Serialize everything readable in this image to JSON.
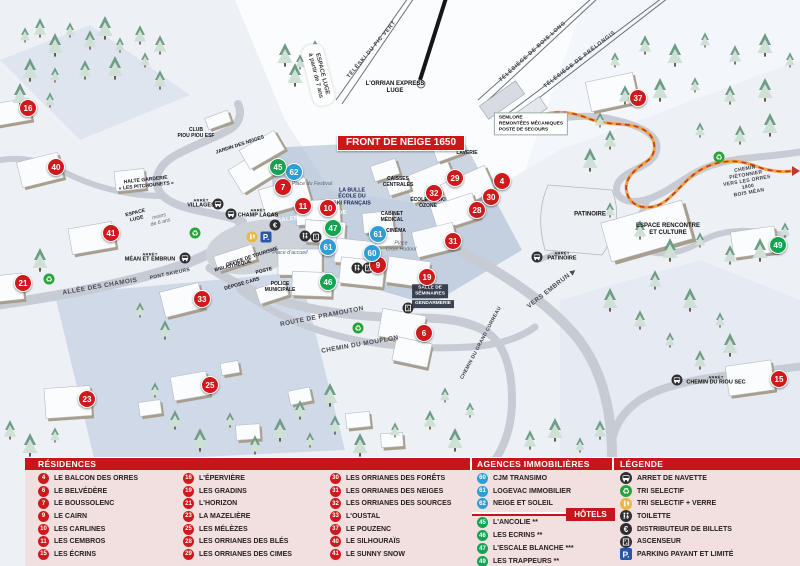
{
  "colors": {
    "residence": "#cf1a1d",
    "agence": "#2e9fd4",
    "hotel": "#13a453",
    "header": "#c6161c",
    "panel_bg": "#f2dfdf",
    "banner": "#cc1719",
    "path_orange": "#f0a23c"
  },
  "map": {
    "banner": "FRONT DE NEIGE 1650",
    "markers": [
      {
        "num": "16",
        "type": "res",
        "x": 28,
        "y": 108
      },
      {
        "num": "40",
        "type": "res",
        "x": 56,
        "y": 167
      },
      {
        "num": "41",
        "type": "res",
        "x": 111,
        "y": 233
      },
      {
        "num": "21",
        "type": "res",
        "x": 23,
        "y": 283
      },
      {
        "num": "33",
        "type": "res",
        "x": 202,
        "y": 299
      },
      {
        "num": "23",
        "type": "res",
        "x": 87,
        "y": 399
      },
      {
        "num": "25",
        "type": "res",
        "x": 210,
        "y": 385
      },
      {
        "num": "7",
        "type": "res",
        "x": 283,
        "y": 187
      },
      {
        "num": "11",
        "type": "res",
        "x": 303,
        "y": 206
      },
      {
        "num": "10",
        "type": "res",
        "x": 328,
        "y": 208
      },
      {
        "num": "9",
        "type": "res",
        "x": 378,
        "y": 265
      },
      {
        "num": "19",
        "type": "res",
        "x": 427,
        "y": 277
      },
      {
        "num": "6",
        "type": "res",
        "x": 424,
        "y": 333
      },
      {
        "num": "29",
        "type": "res",
        "x": 455,
        "y": 178
      },
      {
        "num": "32",
        "type": "res",
        "x": 434,
        "y": 193
      },
      {
        "num": "30",
        "type": "res",
        "x": 491,
        "y": 197
      },
      {
        "num": "4",
        "type": "res",
        "x": 502,
        "y": 181
      },
      {
        "num": "28",
        "type": "res",
        "x": 477,
        "y": 210
      },
      {
        "num": "31",
        "type": "res",
        "x": 453,
        "y": 241
      },
      {
        "num": "37",
        "type": "res",
        "x": 638,
        "y": 98
      },
      {
        "num": "15",
        "type": "res",
        "x": 779,
        "y": 379
      },
      {
        "num": "62",
        "type": "agence",
        "x": 294,
        "y": 172
      },
      {
        "num": "61",
        "type": "agence",
        "x": 328,
        "y": 247
      },
      {
        "num": "61",
        "type": "agence",
        "x": 378,
        "y": 234
      },
      {
        "num": "60",
        "type": "agence",
        "x": 372,
        "y": 253
      },
      {
        "num": "45",
        "type": "hotel",
        "x": 278,
        "y": 167
      },
      {
        "num": "47",
        "type": "hotel",
        "x": 333,
        "y": 228
      },
      {
        "num": "46",
        "type": "hotel",
        "x": 328,
        "y": 282
      },
      {
        "num": "49",
        "type": "hotel",
        "x": 778,
        "y": 245
      }
    ],
    "labels": [
      {
        "text": "ESPACE LUGE\nà partir de 7 ans",
        "x": 318,
        "y": 75,
        "rot": 76,
        "cls": "pill"
      },
      {
        "text": "TÉLÉSKI DU PIC VERT",
        "x": 372,
        "y": 50,
        "rot": -50,
        "cls": "lift"
      },
      {
        "text": "TÉLÉSIÈGE DE BOIS LONG",
        "x": 533,
        "y": 52,
        "rot": -42,
        "cls": "lift"
      },
      {
        "text": "TÉLÉSIÈGE DE PRÉLONGIS",
        "x": 580,
        "y": 60,
        "rot": -38,
        "cls": "lift"
      },
      {
        "text": "L'ORRIAN EXPRESS\nLUGE",
        "x": 395,
        "y": 88,
        "cls": "poi"
      },
      {
        "text": "SEMLORE\nREMONTÉES MÉCANIQUES\nPOSTE DE SECOURS",
        "x": 531,
        "y": 124,
        "cls": "box"
      },
      {
        "text": "CLUB\nPIOU PIOU ESF",
        "x": 196,
        "y": 133,
        "cls": "poi-sm"
      },
      {
        "text": "JARDIN DES NEIGES",
        "x": 240,
        "y": 145,
        "rot": -18,
        "cls": "poi-sm"
      },
      {
        "text": "HALTE GARDERIE\n« LES PITCHOUNETS »",
        "x": 146,
        "y": 183,
        "rot": -6,
        "cls": "poi-sm"
      },
      {
        "text": "ESPACE\nLUGE",
        "x": 136,
        "y": 216,
        "rot": -14,
        "cls": "poi-sm"
      },
      {
        "text": "moins\nde 6 ans",
        "x": 160,
        "y": 220,
        "rot": -14,
        "cls": "place"
      },
      {
        "sub": "ARRÊT",
        "text": "VILLAGES",
        "x": 201,
        "y": 204,
        "cls": "arret"
      },
      {
        "sub": "ARRÊT",
        "text": "CHAMP LACAS",
        "x": 258,
        "y": 214,
        "cls": "arret"
      },
      {
        "sub": "ARRÊT",
        "text": "MÉAN ET EMBRUN",
        "x": 150,
        "y": 258,
        "cls": "arret"
      },
      {
        "text": "ALLÉE DES CHAMOIS",
        "x": 100,
        "y": 287,
        "rot": -10,
        "cls": "road"
      },
      {
        "text": "PONT SKIEURS",
        "x": 170,
        "y": 274,
        "rot": -12,
        "cls": "road-sm"
      },
      {
        "text": "BIBLIOTHÈQUE",
        "x": 233,
        "y": 266,
        "rot": -14,
        "cls": "poi-sm"
      },
      {
        "text": "OFFICE DE TOURISME",
        "x": 252,
        "y": 257,
        "rot": -18,
        "cls": "poi-sm"
      },
      {
        "text": "POSTE",
        "x": 264,
        "y": 271,
        "rot": -14,
        "cls": "poi-sm"
      },
      {
        "text": "DÉPOSE CARS",
        "x": 242,
        "y": 284,
        "rot": -16,
        "cls": "poi-sm"
      },
      {
        "text": "POLICE\nMUNICIPALE",
        "x": 280,
        "y": 287,
        "cls": "poi-sm"
      },
      {
        "text": "Place du Festival",
        "x": 312,
        "y": 184,
        "cls": "place"
      },
      {
        "text": "Place d'accueil",
        "x": 290,
        "y": 253,
        "cls": "place"
      },
      {
        "text": "Place\nCroix Hodoul",
        "x": 401,
        "y": 247,
        "cls": "place"
      },
      {
        "text": "GALERIE MARCHANDE",
        "x": 312,
        "y": 217,
        "rot": -7,
        "cls": "white"
      },
      {
        "text": "LA BULLE\nÉCOLE DU\nSKI FRANÇAIS",
        "x": 352,
        "y": 197,
        "cls": "poi-blue"
      },
      {
        "text": "CAISSES\nCENTRALES",
        "x": 398,
        "y": 182,
        "cls": "poi-sm"
      },
      {
        "text": "CABINET\nMÉDICAL",
        "x": 392,
        "y": 217,
        "cls": "poi-sm"
      },
      {
        "text": "CINÉMA",
        "x": 396,
        "y": 231,
        "cls": "poi-sm"
      },
      {
        "text": "ÉCOLE DE SKI\nOZONE",
        "x": 428,
        "y": 203,
        "cls": "poi-sm"
      },
      {
        "text": "LAVERIE",
        "x": 467,
        "y": 153,
        "cls": "poi-sm"
      },
      {
        "text": "ROUTE DE PRAMOUTON",
        "x": 322,
        "y": 317,
        "rot": -11,
        "cls": "road"
      },
      {
        "text": "CHEMIN DU MOUFLON",
        "x": 360,
        "y": 345,
        "rot": -10,
        "cls": "road"
      },
      {
        "text": "CHEMIN DU GRAND CORREAU",
        "x": 481,
        "y": 343,
        "rot": -62,
        "cls": "road-sm"
      },
      {
        "text": "VERS EMBRUN  ▶",
        "x": 552,
        "y": 289,
        "rot": -38,
        "cls": "road"
      },
      {
        "text": "SALLE DE\nSÉMINAIRES",
        "x": 430,
        "y": 291,
        "cls": "white-box"
      },
      {
        "text": "GENDARMERIE",
        "x": 433,
        "y": 304,
        "cls": "white-box"
      },
      {
        "sub": "ARRÊT",
        "text": "PATINOIRE",
        "x": 562,
        "y": 257,
        "cls": "arret"
      },
      {
        "text": "PATINOIRE",
        "x": 590,
        "y": 215,
        "cls": "poi"
      },
      {
        "text": "ESPACE RENCONTRE\nET CULTURE",
        "x": 668,
        "y": 230,
        "cls": "poi"
      },
      {
        "text": "CHEMIN PIÉTONNIER\nVERS LES ORRES 1800\nBOIS MÉAN",
        "x": 747,
        "y": 181,
        "rot": -10,
        "cls": "road-sm"
      },
      {
        "sub": "ARRÊT",
        "text": "CHEMIN DU RIOU SEC",
        "x": 716,
        "y": 381,
        "cls": "arret"
      }
    ],
    "icons": [
      {
        "icon": "bus",
        "x": 218,
        "y": 204
      },
      {
        "icon": "bus",
        "x": 231,
        "y": 214
      },
      {
        "icon": "bus",
        "x": 185,
        "y": 258
      },
      {
        "icon": "bus",
        "x": 537,
        "y": 257
      },
      {
        "icon": "bus",
        "x": 677,
        "y": 380
      },
      {
        "icon": "recycle",
        "x": 195,
        "y": 233
      },
      {
        "icon": "recycle",
        "x": 49,
        "y": 279
      },
      {
        "icon": "recycle",
        "x": 358,
        "y": 328
      },
      {
        "icon": "recycle",
        "x": 719,
        "y": 157
      },
      {
        "icon": "recycle-glass",
        "x": 252,
        "y": 237
      },
      {
        "icon": "parking",
        "x": 266,
        "y": 237
      },
      {
        "icon": "euro",
        "x": 275,
        "y": 225
      },
      {
        "icon": "toilet",
        "x": 305,
        "y": 236
      },
      {
        "icon": "toilet",
        "x": 357,
        "y": 268
      },
      {
        "icon": "elevator",
        "x": 316,
        "y": 237
      },
      {
        "icon": "elevator",
        "x": 368,
        "y": 268
      },
      {
        "icon": "elevator",
        "x": 408,
        "y": 308
      }
    ]
  },
  "panel": {
    "residences": {
      "title": "RÉSIDENCES",
      "columns": [
        [
          {
            "num": "4",
            "name": "LE BALCON DES ORRES"
          },
          {
            "num": "6",
            "name": "LE BELVÉDÈRE"
          },
          {
            "num": "7",
            "name": "LE BOUSSOLENC"
          },
          {
            "num": "9",
            "name": "LE CAIRN"
          },
          {
            "num": "10",
            "name": "LES CARLINES"
          },
          {
            "num": "11",
            "name": "LES CEMBROS"
          },
          {
            "num": "15",
            "name": "LES ÉCRINS"
          }
        ],
        [
          {
            "num": "16",
            "name": "L'ÉPERVIÈRE"
          },
          {
            "num": "19",
            "name": "LES GRADINS"
          },
          {
            "num": "21",
            "name": "L'HORIZON"
          },
          {
            "num": "23",
            "name": "LA MAZELIÈRE"
          },
          {
            "num": "25",
            "name": "LES MÉLÈZES"
          },
          {
            "num": "28",
            "name": "LES ORRIANES DES BLÉS"
          },
          {
            "num": "29",
            "name": "LES ORRIANES DES CIMES"
          }
        ],
        [
          {
            "num": "30",
            "name": "LES ORRIANES DES FORÊTS"
          },
          {
            "num": "31",
            "name": "LES ORRIANES DES NEIGES"
          },
          {
            "num": "32",
            "name": "LES ORRIANES DES SOURCES"
          },
          {
            "num": "33",
            "name": "L'OUSTAL"
          },
          {
            "num": "37",
            "name": "LE POUZENC"
          },
          {
            "num": "40",
            "name": "LE SILHOURAÏS"
          },
          {
            "num": "41",
            "name": "LE SUNNY SNOW"
          }
        ]
      ]
    },
    "agences": {
      "title": "AGENCES IMMOBILIÈRES",
      "items": [
        {
          "num": "60",
          "name": "CJM TRANSIMO"
        },
        {
          "num": "61",
          "name": "LOGEVAC IMMOBILIER"
        },
        {
          "num": "62",
          "name": "NEIGE ET SOLEIL"
        }
      ]
    },
    "hotels": {
      "title": "HÔTELS",
      "items": [
        {
          "num": "45",
          "name": "L'ANCOLIE **"
        },
        {
          "num": "46",
          "name": "LES ECRINS **"
        },
        {
          "num": "47",
          "name": "L'ESCALE BLANCHE ***"
        },
        {
          "num": "49",
          "name": "LES TRAPPEURS **"
        }
      ]
    },
    "legende": {
      "title": "LÉGENDE",
      "items": [
        {
          "icon": "bus",
          "label": "ARRET DE NAVETTE"
        },
        {
          "icon": "recycle",
          "label": "TRI SELECTIF"
        },
        {
          "icon": "recycle-glass",
          "label": "TRI SELECTIF + VERRE"
        },
        {
          "icon": "toilet",
          "label": "TOILETTE"
        },
        {
          "icon": "euro",
          "label": "DISTRIBUTEUR DE BILLETS"
        },
        {
          "icon": "elevator",
          "label": "ASCENSEUR"
        },
        {
          "icon": "parking",
          "label": "PARKING PAYANT ET LIMITÉ"
        }
      ]
    }
  }
}
